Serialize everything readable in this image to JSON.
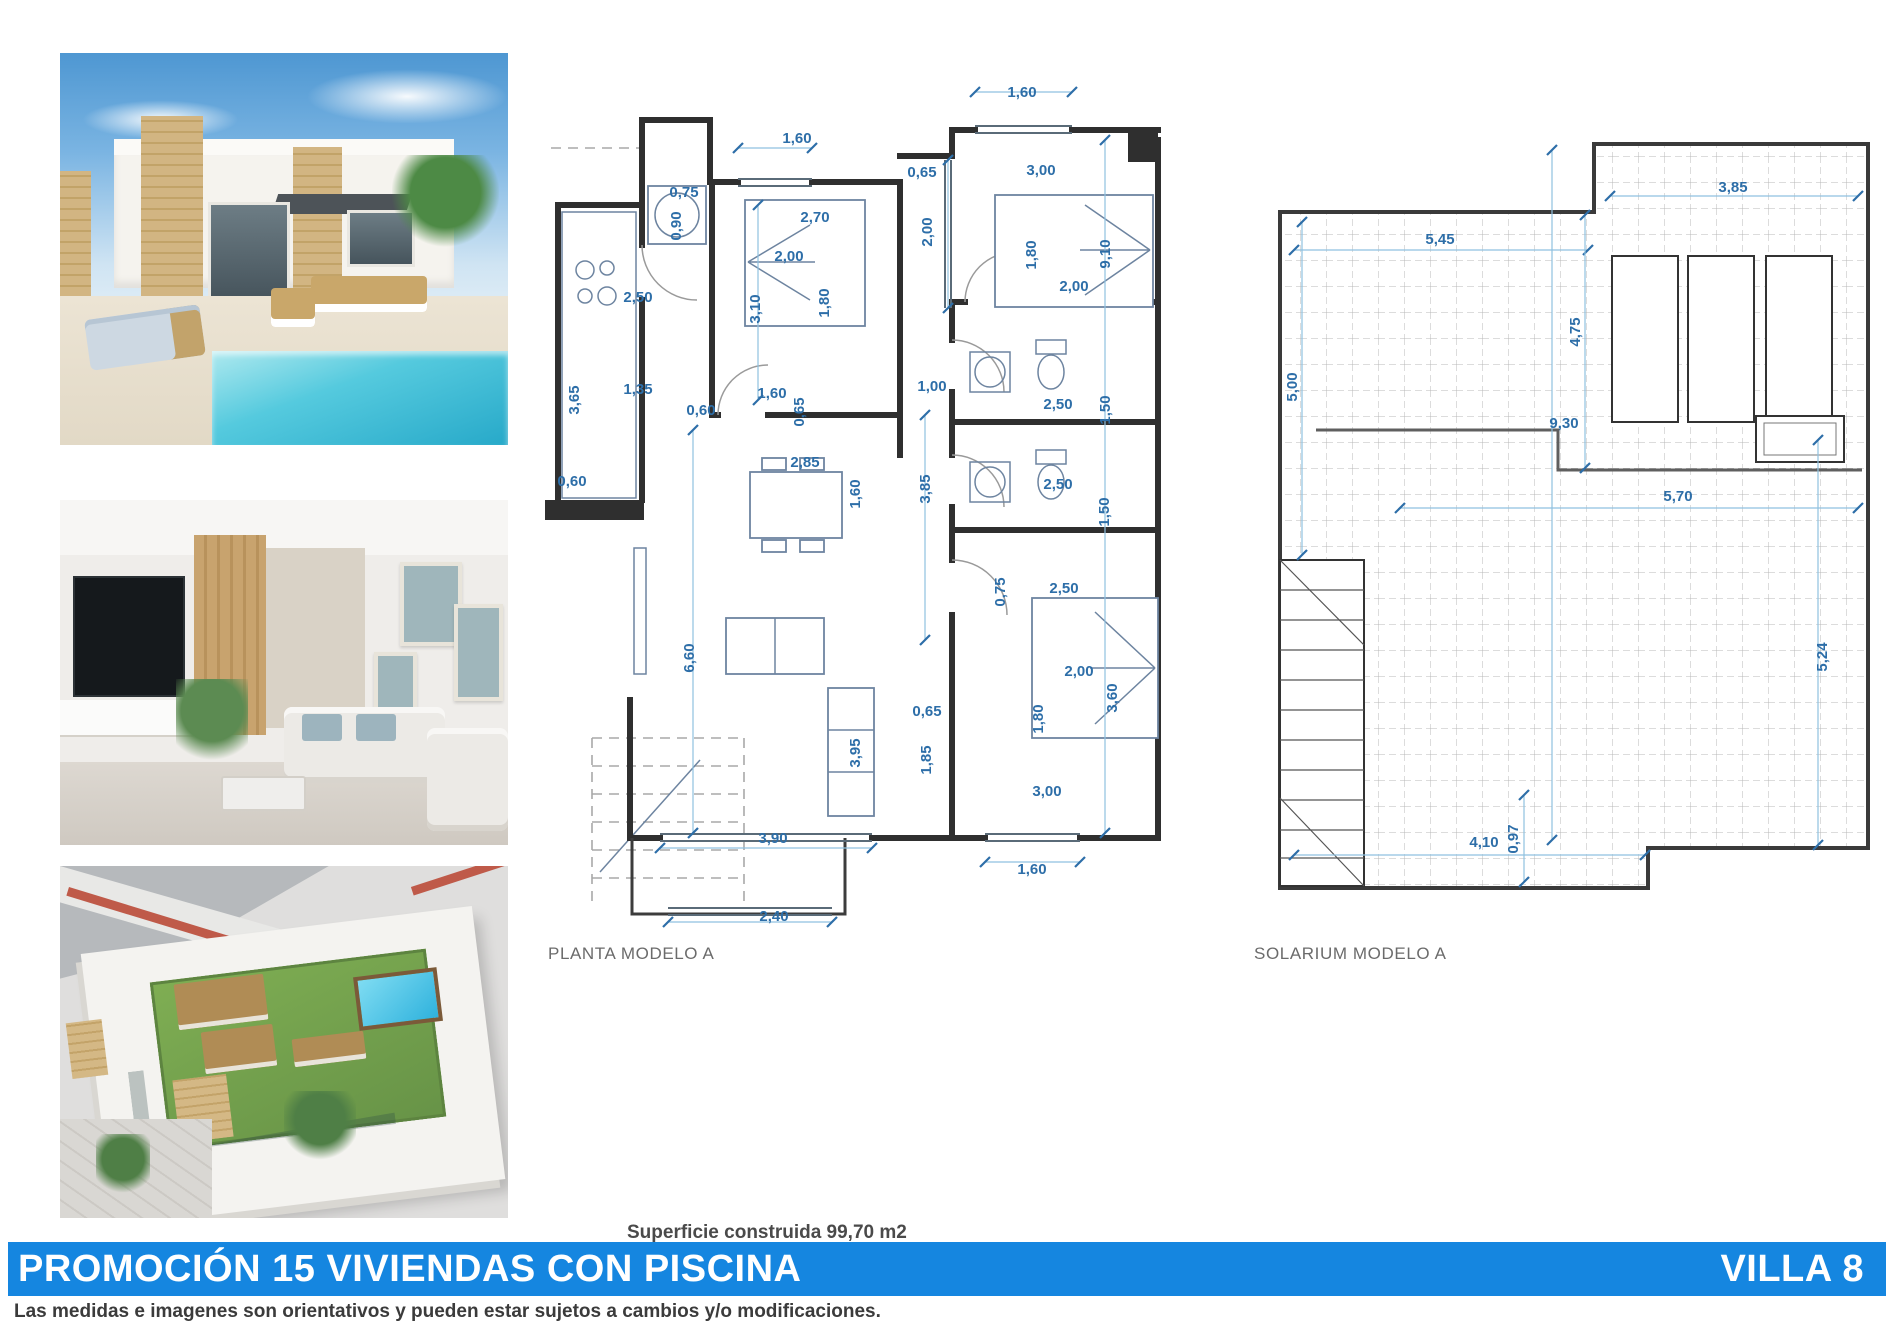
{
  "banner": {
    "title": "PROMOCIÓN 15 VIVIENDAS CON PISCINA",
    "villa": "VILLA 8",
    "color": "#1586e0"
  },
  "disclaimer": "Las medidas e imagenes son orientativos y pueden estar sujetos a cambios y/o modificaciones.",
  "surface_note": "Superficie construida 99,70 m2",
  "colors": {
    "dimension_blue": "#2d6ea8",
    "wall_dark": "#2f2f2f",
    "pool_turquoise": "#27a9c9",
    "lawn_green": "#679347"
  },
  "photos": [
    {
      "name": "villa-exterior-pool-photo",
      "description": "modern white villa with stone pillars, terrace furniture and turquoise pool"
    },
    {
      "name": "living-room-photo",
      "description": "interior living room with TV wall, wood slats and light sofas"
    },
    {
      "name": "aerial-rooftop-photo",
      "description": "aerial render of rooftop solarium with lawn, jacuzzi and rattan sofas"
    }
  ],
  "plans": {
    "planta": {
      "caption": "PLANTA MODELO A",
      "labels": [
        {
          "t": "1,60",
          "x": 1022,
          "y": 97
        },
        {
          "t": "1,60",
          "x": 797,
          "y": 143
        },
        {
          "t": "0,65",
          "x": 922,
          "y": 177
        },
        {
          "t": "3,00",
          "x": 1041,
          "y": 175
        },
        {
          "t": "0,75",
          "x": 684,
          "y": 197
        },
        {
          "t": "0,90",
          "x": 681,
          "y": 226,
          "r": 1
        },
        {
          "t": "2,70",
          "x": 815,
          "y": 222
        },
        {
          "t": "2,00",
          "x": 932,
          "y": 232,
          "r": 1
        },
        {
          "t": "2,00",
          "x": 789,
          "y": 261
        },
        {
          "t": "1,80",
          "x": 1036,
          "y": 255,
          "r": 1
        },
        {
          "t": "9,10",
          "x": 1110,
          "y": 254,
          "r": 1
        },
        {
          "t": "2,00",
          "x": 1074,
          "y": 291
        },
        {
          "t": "3,10",
          "x": 760,
          "y": 309,
          "r": 1
        },
        {
          "t": "1,80",
          "x": 829,
          "y": 303,
          "r": 1
        },
        {
          "t": "2,50",
          "x": 638,
          "y": 302
        },
        {
          "t": "1,35",
          "x": 638,
          "y": 394
        },
        {
          "t": "3,65",
          "x": 579,
          "y": 400,
          "r": 1
        },
        {
          "t": "0,60",
          "x": 701,
          "y": 415
        },
        {
          "t": "1,60",
          "x": 772,
          "y": 398
        },
        {
          "t": "0,65",
          "x": 804,
          "y": 412,
          "r": 1
        },
        {
          "t": "1,00",
          "x": 932,
          "y": 391
        },
        {
          "t": "2,50",
          "x": 1058,
          "y": 409
        },
        {
          "t": "1,50",
          "x": 1110,
          "y": 410,
          "r": 1
        },
        {
          "t": "0,60",
          "x": 572,
          "y": 486
        },
        {
          "t": "2,85",
          "x": 805,
          "y": 467
        },
        {
          "t": "1,60",
          "x": 860,
          "y": 494,
          "r": 1
        },
        {
          "t": "3,85",
          "x": 930,
          "y": 489,
          "r": 1
        },
        {
          "t": "2,50",
          "x": 1058,
          "y": 489
        },
        {
          "t": "1,50",
          "x": 1109,
          "y": 512,
          "r": 1
        },
        {
          "t": "0,75",
          "x": 1005,
          "y": 592,
          "r": 1
        },
        {
          "t": "2,50",
          "x": 1064,
          "y": 593
        },
        {
          "t": "6,60",
          "x": 694,
          "y": 658,
          "r": 1
        },
        {
          "t": "2,00",
          "x": 1079,
          "y": 676
        },
        {
          "t": "3,60",
          "x": 1117,
          "y": 698,
          "r": 1
        },
        {
          "t": "1,80",
          "x": 1043,
          "y": 719,
          "r": 1
        },
        {
          "t": "0,65",
          "x": 927,
          "y": 716
        },
        {
          "t": "1,85",
          "x": 931,
          "y": 760,
          "r": 1
        },
        {
          "t": "3,95",
          "x": 860,
          "y": 753,
          "r": 1
        },
        {
          "t": "3,00",
          "x": 1047,
          "y": 796
        },
        {
          "t": "3,90",
          "x": 773,
          "y": 843
        },
        {
          "t": "1,60",
          "x": 1032,
          "y": 874
        },
        {
          "t": "2,40",
          "x": 774,
          "y": 921
        }
      ],
      "dims": [
        [
          975,
          92,
          1072,
          92
        ],
        [
          738,
          148,
          812,
          148
        ],
        [
          693,
          430,
          693,
          833
        ],
        [
          1105,
          140,
          1105,
          833
        ],
        [
          925,
          415,
          925,
          640
        ],
        [
          660,
          848,
          872,
          848
        ],
        [
          668,
          922,
          832,
          922
        ],
        [
          985,
          862,
          1080,
          862
        ],
        [
          758,
          205,
          758,
          400
        ],
        [
          948,
          160,
          948,
          308
        ]
      ]
    },
    "solarium": {
      "caption": "SOLARIUM MODELO A",
      "labels": [
        {
          "t": "3,85",
          "x": 1733,
          "y": 192
        },
        {
          "t": "5,45",
          "x": 1440,
          "y": 244
        },
        {
          "t": "4,75",
          "x": 1580,
          "y": 332,
          "r": 1
        },
        {
          "t": "5,00",
          "x": 1297,
          "y": 387,
          "r": 1
        },
        {
          "t": "9,30",
          "x": 1564,
          "y": 428
        },
        {
          "t": "5,70",
          "x": 1678,
          "y": 501
        },
        {
          "t": "5,24",
          "x": 1827,
          "y": 657,
          "r": 1
        },
        {
          "t": "4,10",
          "x": 1484,
          "y": 847
        },
        {
          "t": "0,97",
          "x": 1518,
          "y": 839,
          "r": 1
        }
      ],
      "dims": [
        [
          1610,
          196,
          1858,
          196
        ],
        [
          1294,
          250,
          1588,
          250
        ],
        [
          1585,
          215,
          1585,
          468
        ],
        [
          1302,
          222,
          1302,
          555
        ],
        [
          1552,
          150,
          1552,
          840
        ],
        [
          1400,
          508,
          1858,
          508
        ],
        [
          1818,
          440,
          1818,
          845
        ],
        [
          1294,
          855,
          1645,
          855
        ],
        [
          1524,
          795,
          1524,
          882
        ]
      ]
    }
  }
}
